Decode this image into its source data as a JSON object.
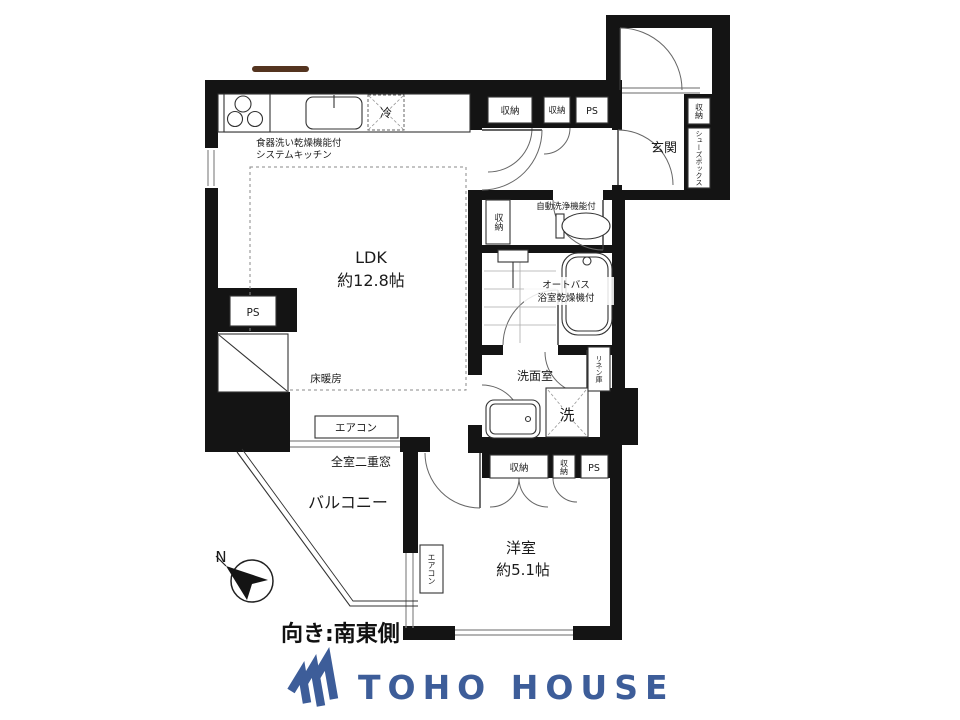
{
  "plan": {
    "ldk": {
      "name": "LDK",
      "size": "約12.8帖"
    },
    "west_room": {
      "name": "洋室",
      "size": "約5.1帖"
    },
    "entrance": "玄関",
    "balcony": "バルコニー",
    "washroom": "洗面室",
    "kitchen_note1": "食器洗い乾燥機能付",
    "kitchen_note2": "システムキッチン",
    "fridge": "冷",
    "floor_heating": "床暖房",
    "storage": "収納",
    "ps": "PS",
    "shoe_box": "シューズボックス",
    "toilet_note": "自動洗浄機能付",
    "auto_bath1": "オートバス",
    "auto_bath2": "浴室乾燥機付",
    "linen": "リネン庫",
    "washer": "洗",
    "aircon": "エアコン",
    "double_window_note": "全室二重窓",
    "compass_north": "N",
    "facing": "向き:南東側"
  },
  "footer": {
    "brand": "TOHO HOUSE"
  },
  "colors": {
    "brand_blue": "#3d5d99",
    "wall": "#141414",
    "artifact_brown": "#54341f"
  }
}
